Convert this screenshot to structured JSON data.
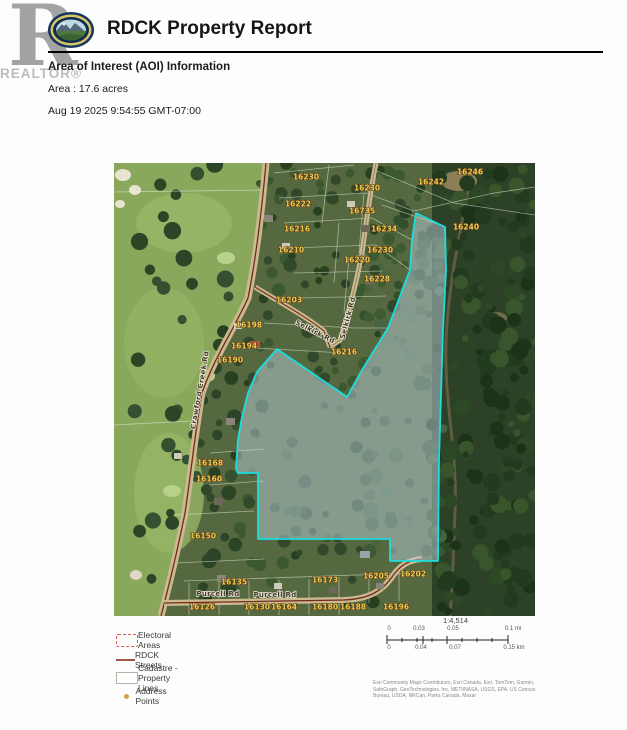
{
  "header": {
    "watermark_letter": "R",
    "watermark_text": "REALTOR®",
    "title": "RDCK Property Report",
    "section_heading": "Area of Interest (AOI) Information",
    "area_line": "Area : 17.6 acres",
    "timestamp": "Aug 19 2025 9:54:55 GMT-07:00"
  },
  "map": {
    "aoi_fill": "#b7ccd4",
    "aoi_stroke": "#1bdde0",
    "aoi_polygon": [
      [
        302,
        50
      ],
      [
        331,
        64
      ],
      [
        332,
        107
      ],
      [
        329,
        167
      ],
      [
        327,
        232
      ],
      [
        325,
        297
      ],
      [
        324,
        398
      ],
      [
        276,
        398
      ],
      [
        276,
        376
      ],
      [
        144,
        376
      ],
      [
        144,
        310
      ],
      [
        124,
        310
      ],
      [
        122,
        305
      ],
      [
        124,
        277
      ],
      [
        128,
        254
      ],
      [
        134,
        230
      ],
      [
        143,
        209
      ],
      [
        163,
        186
      ],
      [
        233,
        234
      ],
      [
        248,
        207
      ],
      [
        274,
        165
      ],
      [
        296,
        107
      ],
      [
        298,
        77
      ]
    ],
    "address_label_color": "#f2cc52",
    "address_labels": [
      {
        "text": "16230",
        "x": 192,
        "y": 14
      },
      {
        "text": "16246",
        "x": 356,
        "y": 9
      },
      {
        "text": "16242",
        "x": 317,
        "y": 19
      },
      {
        "text": "16230",
        "x": 253,
        "y": 25
      },
      {
        "text": "16222",
        "x": 184,
        "y": 41
      },
      {
        "text": "16735",
        "x": 248,
        "y": 48
      },
      {
        "text": "16216",
        "x": 183,
        "y": 66
      },
      {
        "text": "16234",
        "x": 270,
        "y": 66
      },
      {
        "text": "16240",
        "x": 352,
        "y": 64
      },
      {
        "text": "16210",
        "x": 177,
        "y": 87
      },
      {
        "text": "16230",
        "x": 266,
        "y": 87
      },
      {
        "text": "16220",
        "x": 243,
        "y": 97
      },
      {
        "text": "16228",
        "x": 263,
        "y": 116
      },
      {
        "text": "16203",
        "x": 175,
        "y": 137
      },
      {
        "text": "16198",
        "x": 135,
        "y": 162
      },
      {
        "text": "16194",
        "x": 130,
        "y": 183
      },
      {
        "text": "16190",
        "x": 116,
        "y": 197
      },
      {
        "text": "16216",
        "x": 230,
        "y": 189
      },
      {
        "text": "16168",
        "x": 96,
        "y": 300
      },
      {
        "text": "16160",
        "x": 95,
        "y": 316
      },
      {
        "text": "16150",
        "x": 89,
        "y": 373
      },
      {
        "text": "16135",
        "x": 120,
        "y": 419
      },
      {
        "text": "16126",
        "x": 88,
        "y": 444
      },
      {
        "text": "16130",
        "x": 143,
        "y": 444
      },
      {
        "text": "16164",
        "x": 170,
        "y": 444
      },
      {
        "text": "16173",
        "x": 211,
        "y": 417
      },
      {
        "text": "16180",
        "x": 211,
        "y": 444
      },
      {
        "text": "16188",
        "x": 239,
        "y": 444
      },
      {
        "text": "16196",
        "x": 282,
        "y": 444
      },
      {
        "text": "16205",
        "x": 262,
        "y": 413
      },
      {
        "text": "16202",
        "x": 299,
        "y": 411
      }
    ],
    "road_labels": [
      {
        "text": "Selkirk Rd",
        "x": 201,
        "y": 169,
        "rot": 27
      },
      {
        "text": "Selkirk Rd",
        "x": 234,
        "y": 155,
        "rot": -75
      },
      {
        "text": "Crawford Creek Rd",
        "x": 86,
        "y": 227,
        "rot": -80
      },
      {
        "text": "Purcell Rd",
        "x": 104,
        "y": 431,
        "rot": 0
      },
      {
        "text": "Purcell Rd",
        "x": 161,
        "y": 432,
        "rot": 0
      }
    ]
  },
  "legend": {
    "items": [
      {
        "label": "Electoral Areas"
      },
      {
        "label": "RDCK Streets"
      },
      {
        "label": "Cadastre - Property Lines"
      },
      {
        "label": "Address Points"
      }
    ]
  },
  "scale": {
    "ratio": "1:4,514",
    "mi": [
      "0",
      "0.03",
      "0.05",
      "0.1 mi"
    ],
    "km": [
      "0",
      "0.04",
      "0.07",
      "0.15 km"
    ]
  },
  "attribution": {
    "line1": "Esri Community Maps Contributors, Esri Canada, Esri, TomTom, Garmin,",
    "line2": "SafeGraph, GeoTechnologies, Inc, METI/NASA, USGS, EPA, US Census",
    "line3": "Bureau, USDA, NRCan, Parks Canada, Maxar"
  }
}
